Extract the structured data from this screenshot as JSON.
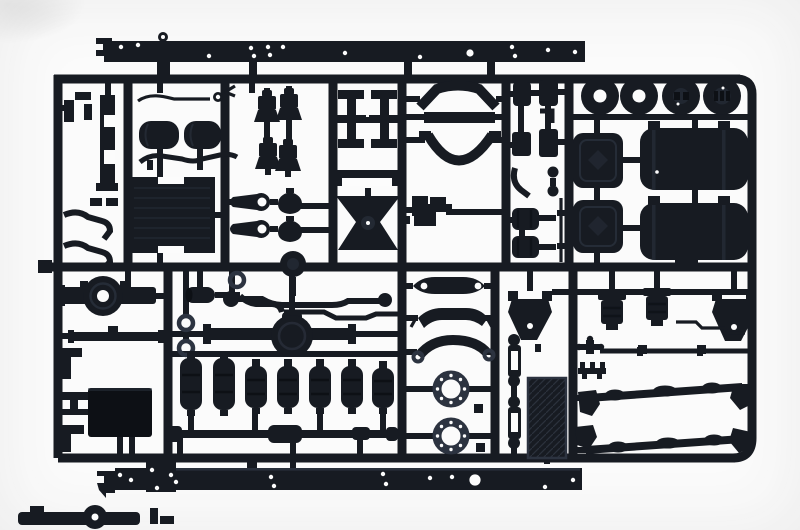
{
  "scene": {
    "subject": "Photograph of an injection-molded dark styrene model kit sprue (parts tree) containing truck chassis components on a white background",
    "background_color": "#fbfbfb",
    "vignette_color": "#ececec",
    "smudge_color": "#cfcfcf",
    "plastic_color": "#171b22",
    "plastic_dark": "#0d1015",
    "plastic_highlight": "#2c3340",
    "hole_color": "#fcfcfc"
  },
  "sprue": {
    "material": "black polystyrene",
    "layout": "rectangular runner grid with rounded corners, two long chassis rails molded across the top and bottom edges",
    "parts_inventory": [
      {
        "name": "chassis-frame-rail",
        "count": 2
      },
      {
        "name": "wheel-disc",
        "count": 4
      },
      {
        "name": "fuel-tank",
        "count": 2
      },
      {
        "name": "battery-box",
        "count": 2
      },
      {
        "name": "radiator",
        "count": 1
      },
      {
        "name": "air-reservoir-tank",
        "count": 2
      },
      {
        "name": "brake-chamber",
        "count": 4
      },
      {
        "name": "shock-absorber-eye",
        "count": 4
      },
      {
        "name": "frame-crossmember",
        "count": 2
      },
      {
        "name": "channel-bracket",
        "count": 1
      },
      {
        "name": "hourglass-mount",
        "count": 1
      },
      {
        "name": "fender-arch",
        "count": 2
      },
      {
        "name": "step-bracket",
        "count": 1
      },
      {
        "name": "front-axle-housing",
        "count": 1
      },
      {
        "name": "rear-axle-differential",
        "count": 2
      },
      {
        "name": "front-axle-beam",
        "count": 1
      },
      {
        "name": "anti-roll-bar",
        "count": 1
      },
      {
        "name": "air-spring-bellows",
        "count": 7
      },
      {
        "name": "drive-shaft",
        "count": 1
      },
      {
        "name": "leaf-spring",
        "count": 3
      },
      {
        "name": "wheel-hub-ring",
        "count": 2
      },
      {
        "name": "spring-shackle",
        "count": 2
      },
      {
        "name": "tread-plate",
        "count": 1
      },
      {
        "name": "engine-mount-bracket",
        "count": 2
      },
      {
        "name": "brake-cylinder",
        "count": 2
      },
      {
        "name": "torque-rod",
        "count": 2
      },
      {
        "name": "tow-hook",
        "count": 2
      },
      {
        "name": "o-ring",
        "count": 3
      },
      {
        "name": "small-bracket",
        "count": 12
      },
      {
        "name": "small-fitting",
        "count": 14
      }
    ]
  }
}
